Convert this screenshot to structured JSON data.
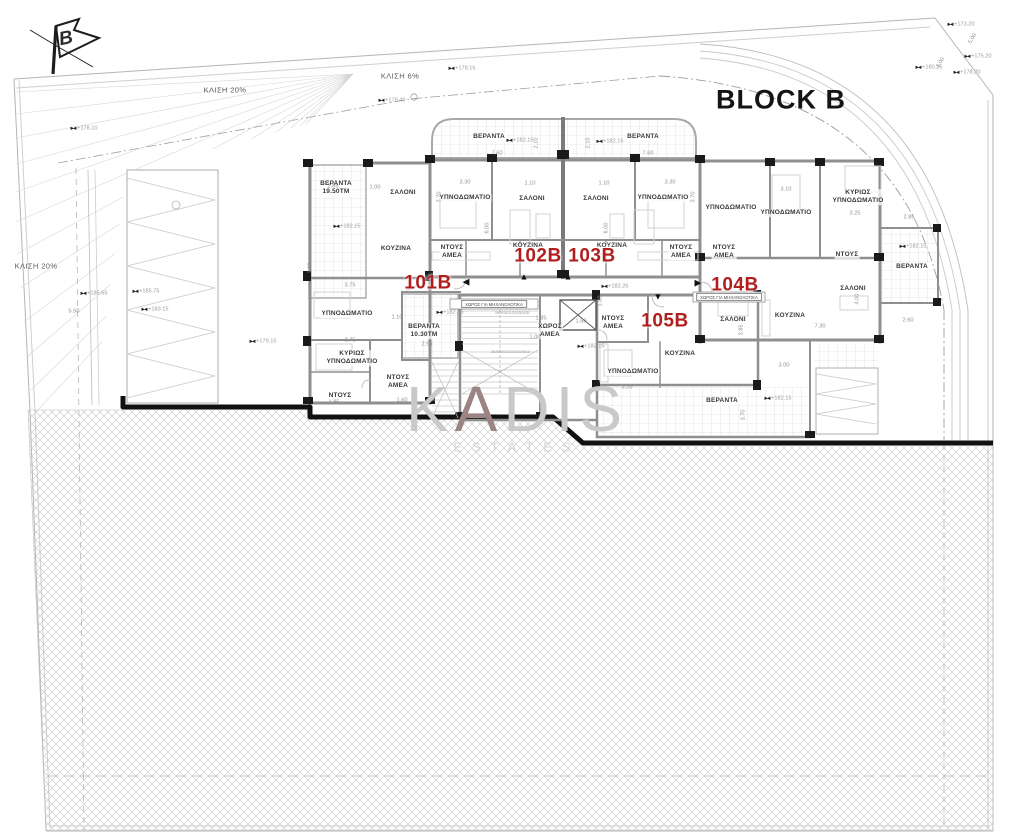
{
  "title": "BLOCK B",
  "north_label": "B",
  "watermark": {
    "w1": "K",
    "w2": "A",
    "w3": "DIS",
    "line2": "ESTATES"
  },
  "colors": {
    "unit_red": "#b01e1e",
    "wall_gray": "#8f8f8f",
    "hatch_gray": "#c2c2c2",
    "grid_gray": "#d2d2d2",
    "text_dark": "#3a3a3a",
    "dim_gray": "#8f8f8f",
    "watermark_gray": "#c9c9c9"
  },
  "units": [
    {
      "id": "101B",
      "x": 428,
      "y": 284
    },
    {
      "id": "102B",
      "x": 538,
      "y": 257
    },
    {
      "id": "103B",
      "x": 592,
      "y": 257
    },
    {
      "id": "104B",
      "x": 735,
      "y": 286
    },
    {
      "id": "105B",
      "x": 665,
      "y": 322
    }
  ],
  "arrows": [
    {
      "g": "◀",
      "x": 466,
      "y": 282
    },
    {
      "g": "▲",
      "x": 524,
      "y": 277
    },
    {
      "g": "▲",
      "x": 568,
      "y": 277
    },
    {
      "g": "▶",
      "x": 698,
      "y": 283
    },
    {
      "g": "▼",
      "x": 658,
      "y": 297
    }
  ],
  "slopes": [
    {
      "text": "ΚΛΙΣΗ 20%",
      "x": 225,
      "y": 90
    },
    {
      "text": "ΚΛΙΣΗ 6%",
      "x": 400,
      "y": 76
    },
    {
      "text": "ΚΛΙΣΗ 20%",
      "x": 36,
      "y": 266
    }
  ],
  "rooms": [
    {
      "text": "ΒΕΡΑΝΤΑ",
      "x": 489,
      "y": 137
    },
    {
      "text": "ΒΕΡΑΝΤΑ",
      "x": 643,
      "y": 137
    },
    {
      "text": "ΒΕΡΑΝΤΑ\n19.50ΤΜ",
      "x": 336,
      "y": 188
    },
    {
      "text": "ΣΑΛΟΝΙ",
      "x": 403,
      "y": 193
    },
    {
      "text": "ΚΟΥΖΙΝΑ",
      "x": 396,
      "y": 249
    },
    {
      "text": "ΥΠΝΟΔΩΜΑΤΙΟ",
      "x": 465,
      "y": 198
    },
    {
      "text": "ΣΑΛΟΝΙ",
      "x": 532,
      "y": 199
    },
    {
      "text": "ΣΑΛΟΝΙ",
      "x": 596,
      "y": 199
    },
    {
      "text": "ΥΠΝΟΔΩΜΑΤΙΟ",
      "x": 663,
      "y": 198
    },
    {
      "text": "ΝΤΟΥΣ\nΑΜΕΑ",
      "x": 452,
      "y": 252
    },
    {
      "text": "ΚΟΥΖΙΝΑ",
      "x": 528,
      "y": 246
    },
    {
      "text": "ΚΟΥΖΙΝΑ",
      "x": 612,
      "y": 246
    },
    {
      "text": "ΝΤΟΥΣ\nΑΜΕΑ",
      "x": 681,
      "y": 252
    },
    {
      "text": "ΝΤΟΥΣ\nΑΜΕΑ",
      "x": 724,
      "y": 252
    },
    {
      "text": "ΥΠΝΟΔΩΜΑΤΙΟ",
      "x": 731,
      "y": 208
    },
    {
      "text": "ΥΠΝΟΔΩΜΑΤΙΟ",
      "x": 786,
      "y": 213
    },
    {
      "text": "ΚΥΡΙΩΣ\nΥΠΝΟΔΩΜΑΤΙΟ",
      "x": 858,
      "y": 197
    },
    {
      "text": "ΝΤΟΥΣ",
      "x": 847,
      "y": 255
    },
    {
      "text": "ΒΕΡΑΝΤΑ",
      "x": 912,
      "y": 267
    },
    {
      "text": "ΣΑΛΟΝΙ",
      "x": 853,
      "y": 289
    },
    {
      "text": "ΚΟΥΖΙΝΑ",
      "x": 790,
      "y": 316
    },
    {
      "text": "ΣΑΛΟΝΙ",
      "x": 733,
      "y": 320
    },
    {
      "text": "ΝΤΟΥΣ\nΑΜΕΑ",
      "x": 613,
      "y": 323
    },
    {
      "text": "ΚΟΥΖΙΝΑ",
      "x": 680,
      "y": 354
    },
    {
      "text": "ΥΠΝΟΔΩΜΑΤΙΟ",
      "x": 633,
      "y": 372
    },
    {
      "text": "ΒΕΡΑΝΤΑ",
      "x": 722,
      "y": 401
    },
    {
      "text": "ΥΠΝΟΔΩΜΑΤΙΟ",
      "x": 347,
      "y": 314
    },
    {
      "text": "ΒΕΡΑΝΤΑ\n10.30ΤΜ",
      "x": 424,
      "y": 331
    },
    {
      "text": "ΚΥΡΙΩΣ\nΥΠΝΟΔΩΜΑΤΙΟ",
      "x": 352,
      "y": 358
    },
    {
      "text": "ΝΤΟΥΣ\nΑΜΕΑ",
      "x": 398,
      "y": 382
    },
    {
      "text": "ΝΤΟΥΣ",
      "x": 340,
      "y": 396
    },
    {
      "text": "ΧΩΡΟΣ\nΑΜΕΑ",
      "x": 550,
      "y": 331
    }
  ],
  "banners": [
    {
      "text": "ΧΩΡΟΣ ΓΙΑ ΜΗΧΑΝΟΛΟΓΙΚΑ",
      "x": 494,
      "y": 304
    },
    {
      "text": "ΧΩΡΟΣ ΓΙΑ ΜΗΧΑΝΟΛΟΓΙΚΑ",
      "x": 729,
      "y": 297
    }
  ],
  "stair_numbers": [
    {
      "text": "28/29/30/31/32/33/34/35",
      "x": 512,
      "y": 313
    },
    {
      "text": "26/25/24/23/22/21/20/19/18",
      "x": 510,
      "y": 352
    }
  ],
  "elevations": [
    {
      "text": "+178.10",
      "x": 84,
      "y": 129
    },
    {
      "text": "+179.40",
      "x": 392,
      "y": 101
    },
    {
      "text": "+179.15",
      "x": 462,
      "y": 69
    },
    {
      "text": "+185.65",
      "x": 94,
      "y": 294
    },
    {
      "text": "+185.75",
      "x": 146,
      "y": 292
    },
    {
      "text": "+183.15",
      "x": 155,
      "y": 310
    },
    {
      "text": "+179.15",
      "x": 263,
      "y": 342
    },
    {
      "text": "+182.15",
      "x": 520,
      "y": 141
    },
    {
      "text": "+182.15",
      "x": 610,
      "y": 142
    },
    {
      "text": "+182.15",
      "x": 347,
      "y": 227
    },
    {
      "text": "+182.15",
      "x": 913,
      "y": 247
    },
    {
      "text": "+182.26",
      "x": 615,
      "y": 287
    },
    {
      "text": "+182.15",
      "x": 591,
      "y": 347
    },
    {
      "text": "+182.15",
      "x": 450,
      "y": 313
    },
    {
      "text": "+182.15",
      "x": 778,
      "y": 399
    },
    {
      "text": "+180.25",
      "x": 929,
      "y": 68
    },
    {
      "text": "+178.20",
      "x": 967,
      "y": 73
    },
    {
      "text": "+175.20",
      "x": 978,
      "y": 57
    },
    {
      "text": "+173.20",
      "x": 961,
      "y": 25
    }
  ],
  "dimensions": [
    {
      "text": "7.60",
      "x": 497,
      "y": 154
    },
    {
      "text": "7.60",
      "x": 648,
      "y": 154
    },
    {
      "text": "3.30",
      "x": 465,
      "y": 183
    },
    {
      "text": "1.10",
      "x": 530,
      "y": 184
    },
    {
      "text": "1.10",
      "x": 604,
      "y": 184
    },
    {
      "text": "3.30",
      "x": 670,
      "y": 183
    },
    {
      "text": "3.70",
      "x": 440,
      "y": 197,
      "rot": -90
    },
    {
      "text": "3.70",
      "x": 694,
      "y": 197,
      "rot": -90
    },
    {
      "text": "6.00",
      "x": 488,
      "y": 228,
      "rot": -90
    },
    {
      "text": "6.00",
      "x": 607,
      "y": 228,
      "rot": -90
    },
    {
      "text": "2.10",
      "x": 537,
      "y": 143,
      "rot": -90
    },
    {
      "text": "2.10",
      "x": 589,
      "y": 143,
      "rot": -90
    },
    {
      "text": "2.85",
      "x": 333,
      "y": 187
    },
    {
      "text": "1.00",
      "x": 375,
      "y": 188
    },
    {
      "text": "1.30",
      "x": 311,
      "y": 268,
      "rot": -90
    },
    {
      "text": "3.75",
      "x": 350,
      "y": 286
    },
    {
      "text": "1.10",
      "x": 397,
      "y": 318
    },
    {
      "text": "2.95",
      "x": 427,
      "y": 345
    },
    {
      "text": "3.75",
      "x": 350,
      "y": 341
    },
    {
      "text": "1.60",
      "x": 402,
      "y": 401
    },
    {
      "text": "1.85",
      "x": 334,
      "y": 403
    },
    {
      "text": "3.10",
      "x": 786,
      "y": 190
    },
    {
      "text": "3.25",
      "x": 855,
      "y": 214
    },
    {
      "text": "2.85",
      "x": 909,
      "y": 218
    },
    {
      "text": "2.60",
      "x": 908,
      "y": 321
    },
    {
      "text": "7.30",
      "x": 820,
      "y": 327
    },
    {
      "text": "3.00",
      "x": 784,
      "y": 366
    },
    {
      "text": "4.00",
      "x": 858,
      "y": 299,
      "rot": -90
    },
    {
      "text": "1.85",
      "x": 541,
      "y": 319
    },
    {
      "text": "1.80",
      "x": 581,
      "y": 322
    },
    {
      "text": "1.00",
      "x": 535,
      "y": 338
    },
    {
      "text": "1.80",
      "x": 601,
      "y": 301,
      "rot": -90
    },
    {
      "text": "3.20",
      "x": 627,
      "y": 388
    },
    {
      "text": "3.85",
      "x": 742,
      "y": 330,
      "rot": -90
    },
    {
      "text": "3.70",
      "x": 744,
      "y": 415,
      "rot": -90
    },
    {
      "text": "5.50",
      "x": 74,
      "y": 312
    },
    {
      "text": "5.00",
      "x": 973,
      "y": 39,
      "rot": -58
    },
    {
      "text": "1.00",
      "x": 941,
      "y": 63,
      "rot": -58
    }
  ]
}
